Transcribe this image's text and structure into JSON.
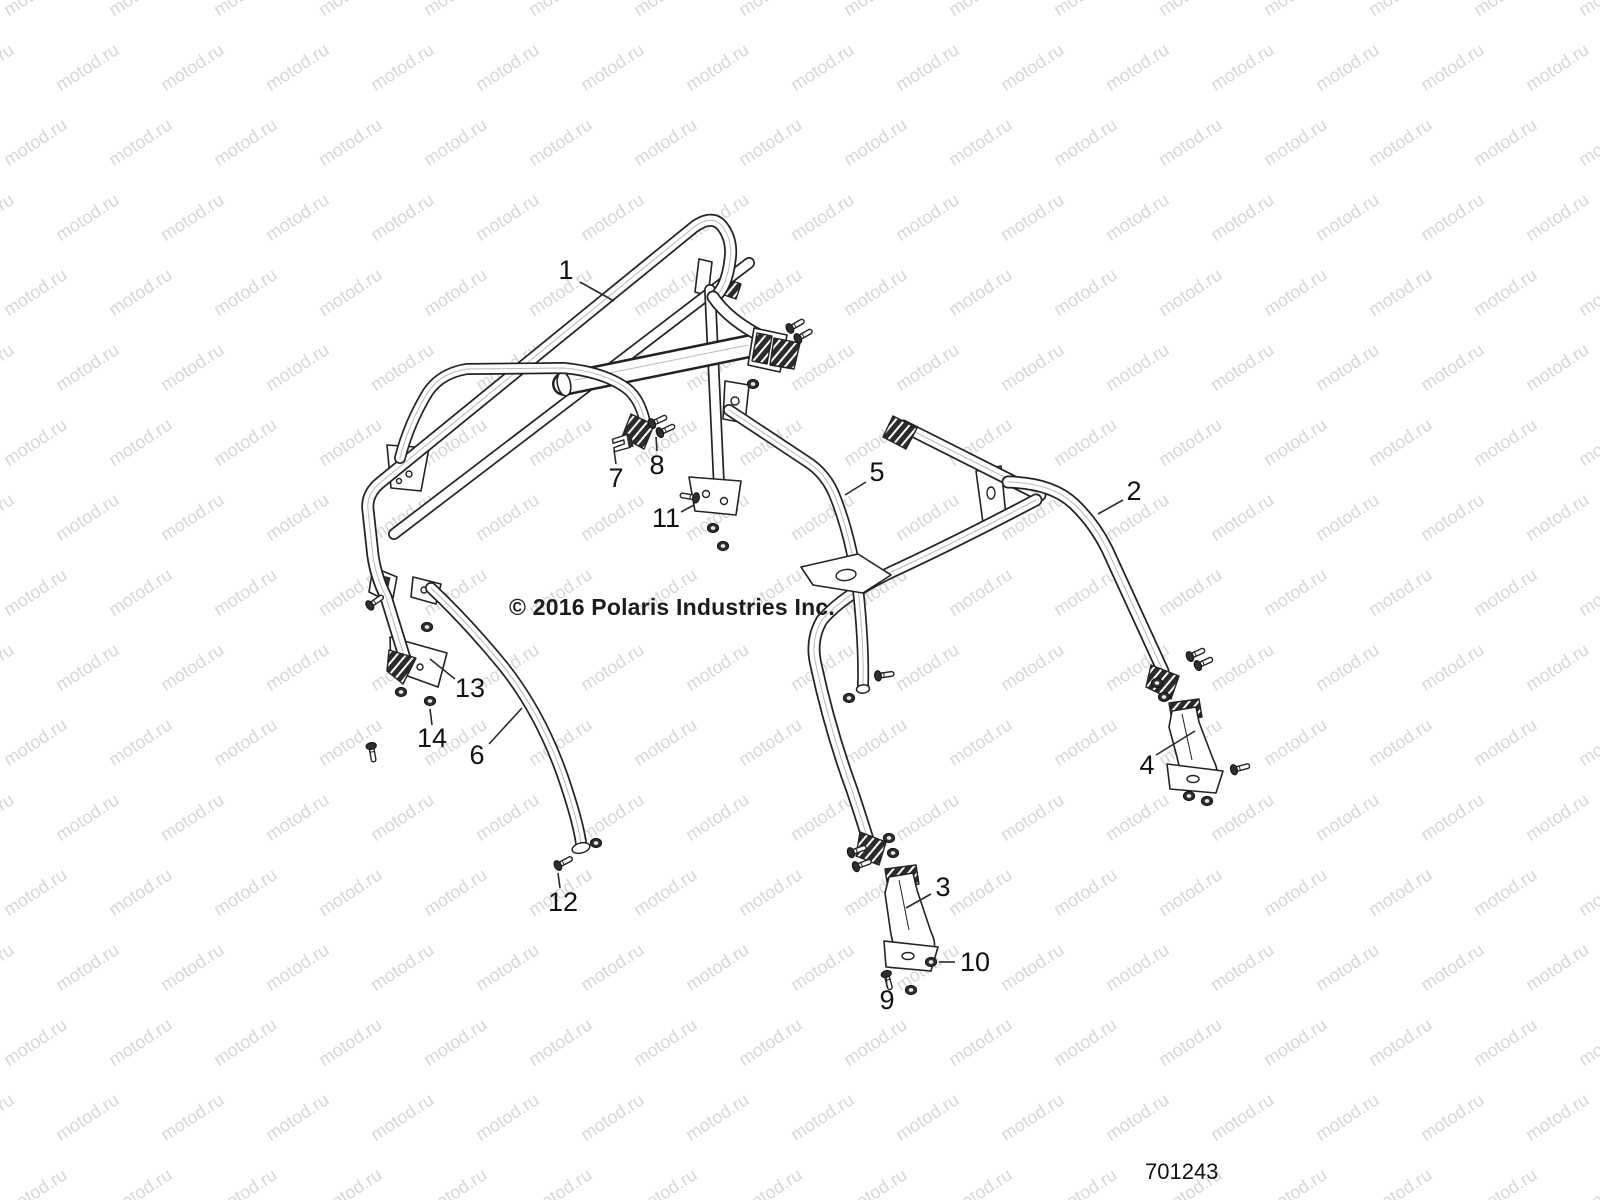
{
  "page": {
    "background": "#ffffff"
  },
  "watermark": {
    "text": "motod.ru",
    "color": "#d6d6d6",
    "font_size": 18,
    "angle_deg": -33,
    "col_spacing": 105,
    "row_spacing": 75,
    "row_offset": 52,
    "rows": 17,
    "cols": 17
  },
  "annotations": {
    "copyright": "© 2016 Polaris Industries Inc.",
    "diagram_number": "701243"
  },
  "callouts": [
    {
      "label": "1",
      "x": 566,
      "y": 270,
      "leader": [
        580,
        282,
        614,
        301
      ]
    },
    {
      "label": "2",
      "x": 1134,
      "y": 491,
      "leader": [
        1123,
        500,
        1098,
        514
      ]
    },
    {
      "label": "3",
      "x": 943,
      "y": 887,
      "leader": [
        931,
        894,
        906,
        908
      ]
    },
    {
      "label": "4",
      "x": 1147,
      "y": 765,
      "leader": [
        1156,
        755,
        1195,
        731
      ]
    },
    {
      "label": "5",
      "x": 877,
      "y": 472,
      "leader": [
        866,
        482,
        845,
        495
      ]
    },
    {
      "label": "6",
      "x": 477,
      "y": 755,
      "leader": [
        489,
        744,
        522,
        708
      ]
    },
    {
      "label": "7",
      "x": 616,
      "y": 478,
      "leader": [
        616,
        464,
        614,
        450
      ]
    },
    {
      "label": "8",
      "x": 657,
      "y": 465,
      "leader": [
        657,
        451,
        656,
        437
      ]
    },
    {
      "label": "9",
      "x": 887,
      "y": 1000,
      "leader": [
        887,
        987,
        886,
        977
      ]
    },
    {
      "label": "10",
      "x": 975,
      "y": 962,
      "leader": [
        955,
        962,
        939,
        962
      ]
    },
    {
      "label": "11",
      "x": 666,
      "y": 518,
      "leader": [
        681,
        512,
        694,
        505
      ]
    },
    {
      "label": "12",
      "x": 563,
      "y": 902,
      "leader": [
        560,
        888,
        558,
        873
      ]
    },
    {
      "label": "13",
      "x": 470,
      "y": 688,
      "leader": [
        455,
        679,
        430,
        659
      ]
    },
    {
      "label": "14",
      "x": 432,
      "y": 738,
      "leader": [
        432,
        725,
        430,
        709
      ]
    }
  ]
}
